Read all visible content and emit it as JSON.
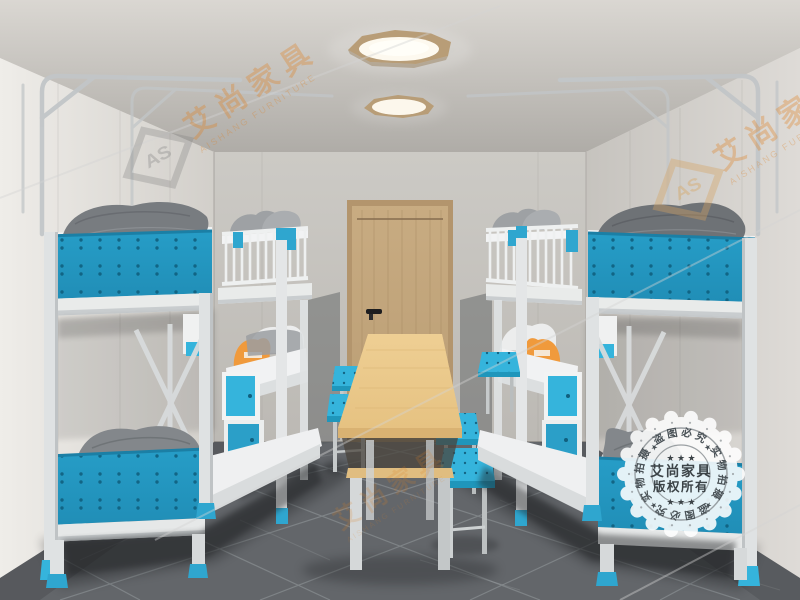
{
  "brand": {
    "name_cn": "艾尚家具",
    "name_en": "AISHANG FURNITURE",
    "logo_initials": "AS"
  },
  "stamp": {
    "center_line1": "艾尚家具",
    "center_line2": "版权所有",
    "ring_top": "盗图必究",
    "ring_bottom": "盗图必究",
    "ring_left": "实物拍摄",
    "ring_right": "实物拍摄",
    "stars_row": "★ ★ ★",
    "ring_star": "★"
  },
  "colors": {
    "teal_panel": "#2397c1",
    "teal_bright": "#35b4dc",
    "orange_pillow": "#f09a3c",
    "door_wood": "#c2a57c",
    "table_wood": "#ecca8d",
    "light_rim_wood": "#b89d77",
    "floor_gray": "#63666a",
    "wall_light": "#e9e7e3",
    "metal_frame": "#e8eaeb",
    "pillow_gray": "#787c80",
    "bedding_white": "#eff0f1",
    "watermark_orange": "#df8024"
  }
}
